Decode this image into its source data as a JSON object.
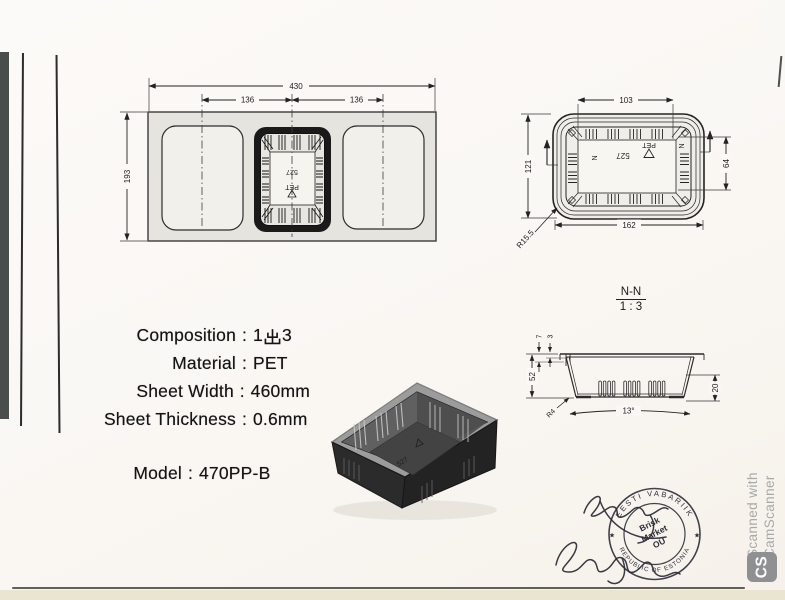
{
  "specs": {
    "rows": [
      {
        "label": "Composition",
        "sep": ":",
        "value": "1出3",
        "value_pre": "1",
        "value_cjk": "出",
        "value_post": "3"
      },
      {
        "label": "Material",
        "sep": ":",
        "value": "PET"
      },
      {
        "label": "Sheet Width",
        "sep": ":",
        "value": "460mm"
      },
      {
        "label": "Sheet Thickness",
        "sep": ":",
        "value": "0.6mm"
      }
    ],
    "model": {
      "label": "Model",
      "sep": ":",
      "value": "470PP-B"
    }
  },
  "sheet_layout": {
    "overall_width": "430",
    "pitch_left": "136",
    "pitch_right": "136",
    "sheet_height": "193"
  },
  "top_view": {
    "top_width": "103",
    "height": "121",
    "bottom_width": "162",
    "side_depth": "64",
    "corner_radius": "R15.5",
    "section_mark": "N"
  },
  "section_view": {
    "name": "N-N",
    "scale": "1 : 3",
    "lip_height": "7",
    "lip_step": "3",
    "total_height": "52",
    "foot_height": "20",
    "taper_angle": "13°",
    "bottom_radius": "R4"
  },
  "markings": {
    "mold_number": "527",
    "material": "PET"
  },
  "stamp": {
    "top_arc": "EESTI VABARIIK",
    "bottom_arc": "REPUBLIC OF ESTONIA",
    "line1": "Brisk",
    "line2": "Market",
    "line3": "OÜ",
    "star": "★"
  },
  "watermark": {
    "line1": "Scanned with",
    "line2": "CamScanner",
    "badge": "CS"
  },
  "colors": {
    "paper": "#faf7f3",
    "ink": "#1c1c1c",
    "stamp_ink": "#2d2d38",
    "watermark_gray": "#a9a9a9"
  }
}
